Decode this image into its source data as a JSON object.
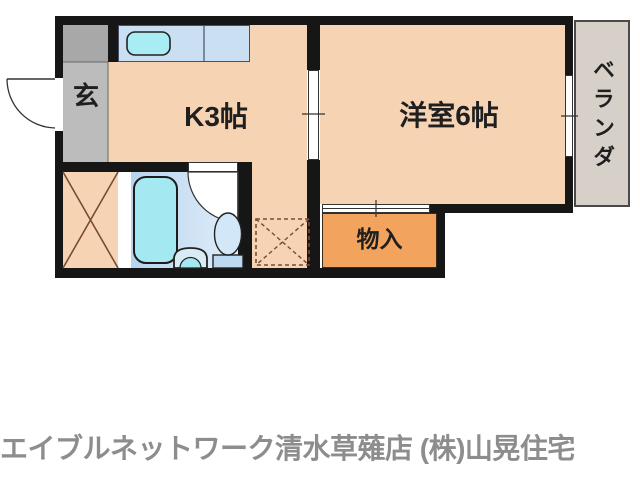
{
  "floor_plan": {
    "rooms": {
      "genkan": "玄",
      "kitchen": "K3帖",
      "western_room": "洋室6帖",
      "storage": "物入",
      "veranda": "ベランダ"
    },
    "fixtures": {
      "entrance_door": "hinged-door-arc",
      "kitchen_counter": "counter-with-sink",
      "sink": "sink-basin",
      "sliding_door_kitchen_room": "sliding-door",
      "window": "window",
      "bathtub": "bathtub",
      "bathroom_door": "hinged-door-arc",
      "washbasin": "washbasin",
      "toilet": "toilet",
      "washing_machine_space": "dashed-cross-box",
      "closet_cross": "solid-cross-box",
      "storage_sliding_door": "sliding-door"
    },
    "colors": {
      "wall": "#161616",
      "room_floor": "#f5d3b3",
      "storage_floor": "#f2a35e",
      "genkan_floor": "#bcbcbc",
      "genkan_cabinet": "#a8a8a8",
      "counter": "#cbdff2",
      "bath_floor_left": "#b7d4ee",
      "bath_floor_right": "#e2eefa",
      "fixture_cyan": "#a4e8f2",
      "veranda": "#d6d0c8",
      "cross_lines": "#7c4a38",
      "footer_text": "#8d8d8d"
    }
  },
  "footer": {
    "text": "エイブルネットワーク清水草薙店 (株)山晃住宅"
  }
}
